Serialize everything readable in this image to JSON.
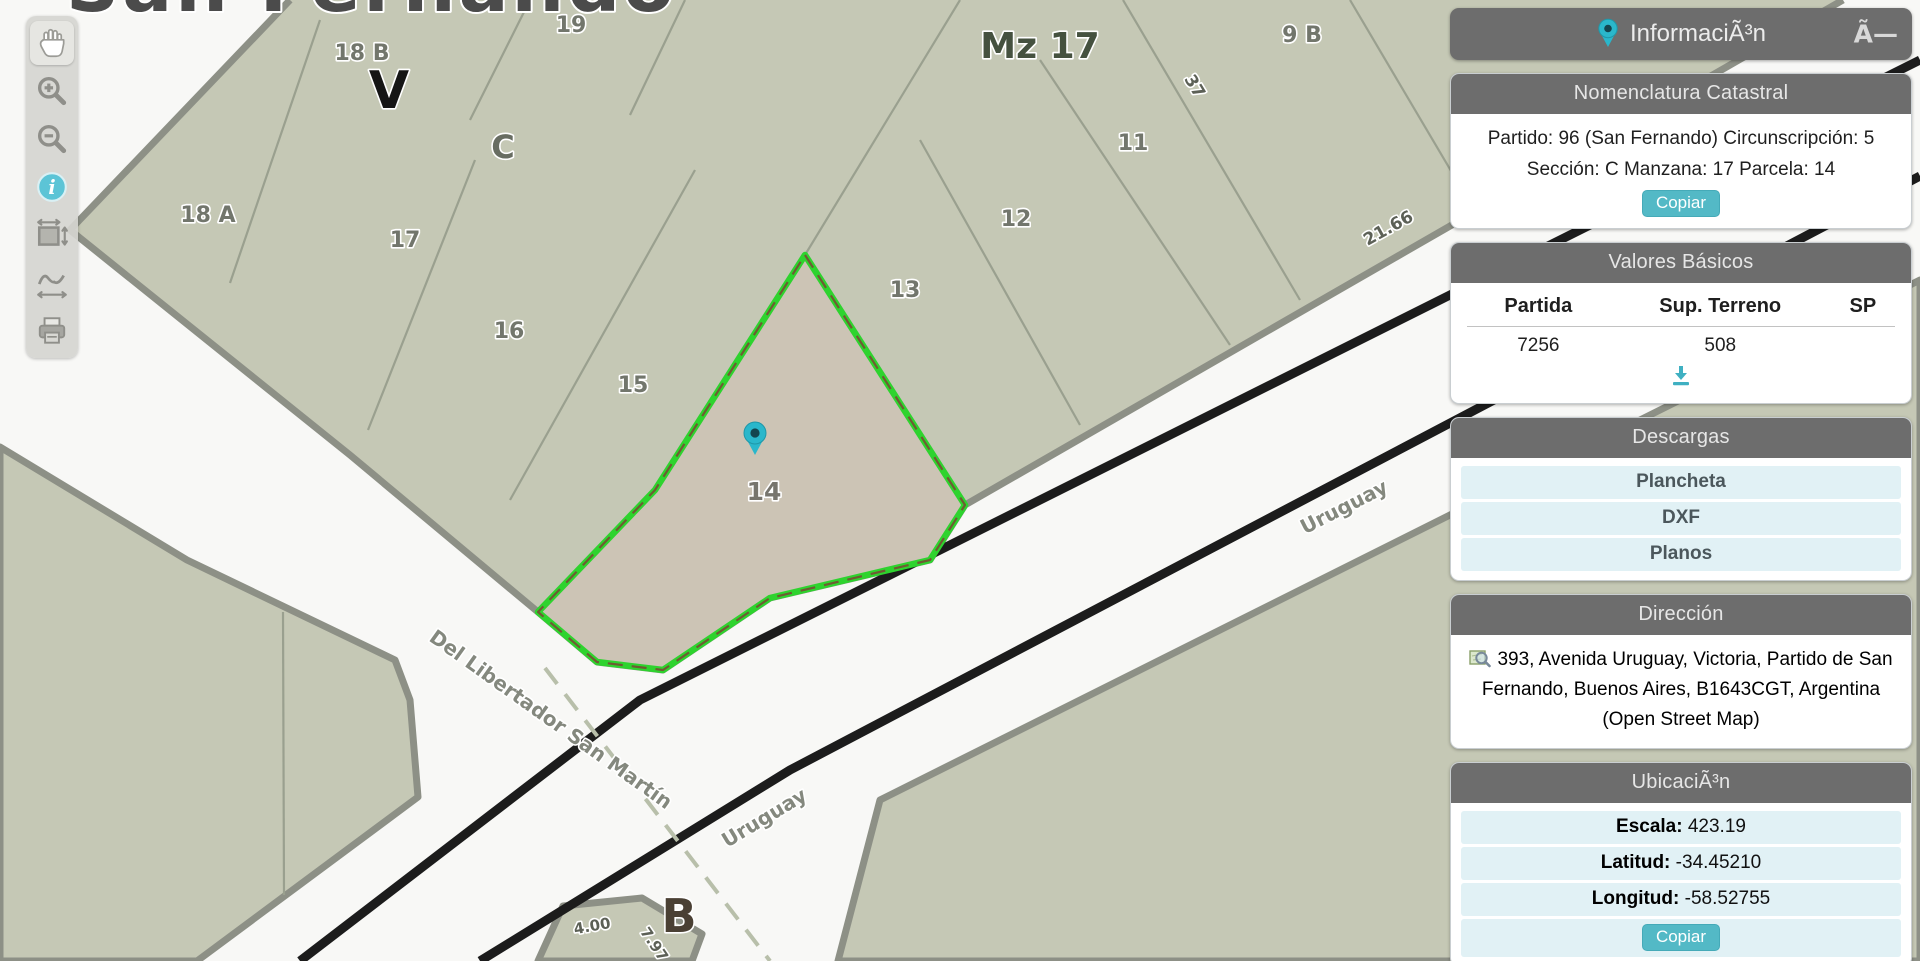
{
  "map": {
    "city_title": "San Fernando",
    "manzana_label": "Mz 17",
    "selected_parcel": "14",
    "parcel_labels": {
      "p19": "19",
      "p18b": "18 B",
      "v": "V",
      "c": "C",
      "p18a": "18 A",
      "p17": "17",
      "p16": "16",
      "p15": "15",
      "p14": "14",
      "p13": "13",
      "p12": "12",
      "p11": "11",
      "p9b": "9 B",
      "b": "B"
    },
    "measurements": {
      "m37": "37",
      "m2166": "21.66",
      "m400": "4.00",
      "m797": "7.97"
    },
    "streets": {
      "libertador": "Del Libertador San Martín",
      "uruguay_bottom": "Uruguay",
      "uruguay_right": "Uruguay"
    },
    "colors": {
      "block_fill": "#c5c8b5",
      "selected_fill": "#ccc4b5",
      "highlight_green": "#2ed32e",
      "pin_teal": "#2ab7cb"
    }
  },
  "toolbar": {
    "tools": [
      "pan",
      "zoom-in",
      "zoom-out",
      "info",
      "measure-area",
      "measure-distance",
      "print"
    ]
  },
  "panel": {
    "header": {
      "title": "InformaciÃ³n",
      "close": "Ã—"
    },
    "nomenclatura": {
      "title": "Nomenclatura Catastral",
      "line1": "Partido: 96 (San Fernando) Circunscripción: 5",
      "line2": "Sección: C Manzana: 17 Parcela: 14",
      "copy_label": "Copiar"
    },
    "valores": {
      "title": "Valores Básicos",
      "columns": [
        "Partida",
        "Sup. Terreno",
        "SP"
      ],
      "row": {
        "partida": "7256",
        "sup_terreno": "508",
        "sp": ""
      }
    },
    "descargas": {
      "title": "Descargas",
      "items": [
        "Plancheta",
        "DXF",
        "Planos"
      ]
    },
    "direccion": {
      "title": "Dirección",
      "text": "393, Avenida Uruguay, Victoria, Partido de San Fernando, Buenos Aires, B1643CGT, Argentina (Open Street Map)"
    },
    "ubicacion": {
      "title": "UbicaciÃ³n",
      "rows": [
        {
          "label": "Escala:",
          "value": "423.19"
        },
        {
          "label": "Latitud:",
          "value": "-34.45210"
        },
        {
          "label": "Longitud:",
          "value": "-58.52755"
        }
      ],
      "copy_label": "Copiar"
    }
  }
}
